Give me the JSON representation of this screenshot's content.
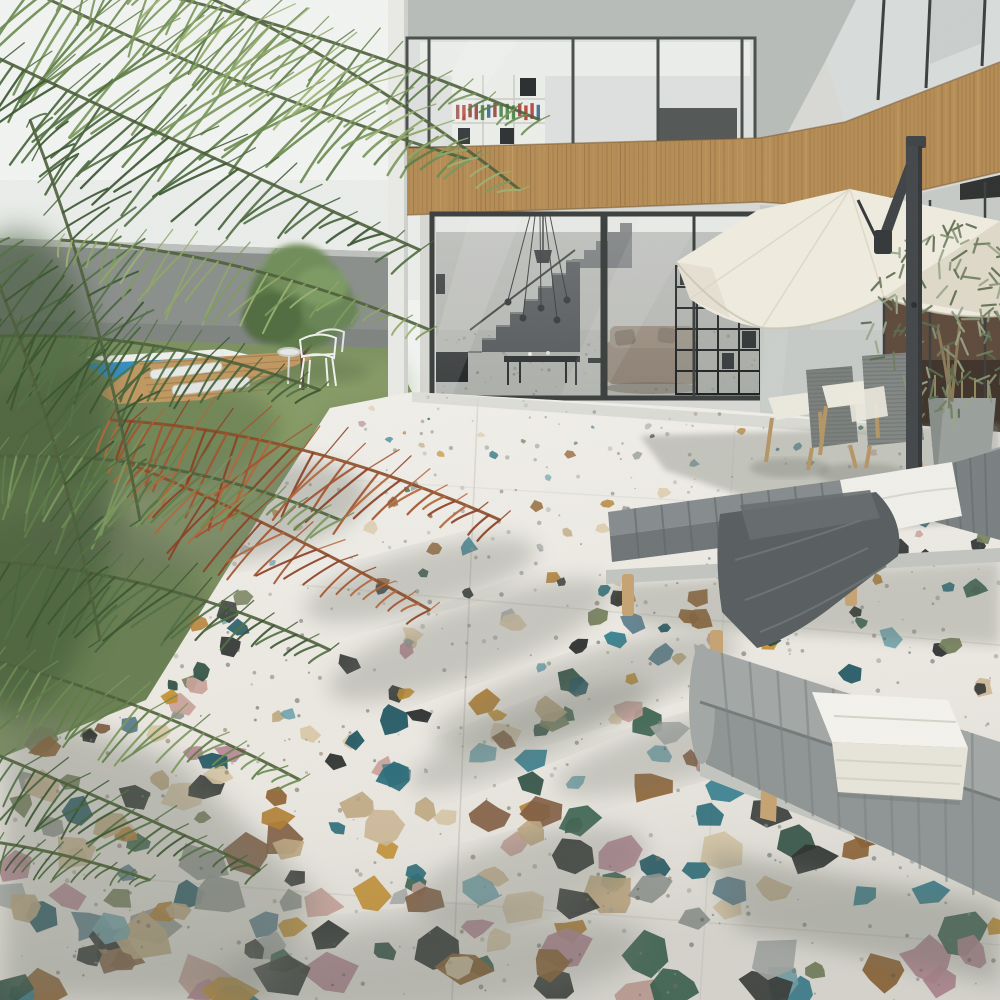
{
  "scene": {
    "title": "Outdoor patio of a modern villa with multicolor terrazzo floor, palm tree, pool, cantilever umbrella and sun loungers",
    "objects": {
      "palm_tree": "large palm with green and one dried orange frond, upper left",
      "boundary_wall": "grey garden wall",
      "lawn": "green grass lawn",
      "swimming_pool": "small blue pool with white coping and ladder",
      "pool_deck": "wooden deck with two white loungers",
      "garden_tree": "small leafy tree on lawn",
      "garden_chairs": "two white wire chairs with side table on grass",
      "villa": "two-storey villa, concrete, glass walls, wooden slat balustrade",
      "bookshelf_upstairs": "white bookshelf behind upper glass",
      "living_room": "sofa, coffee table, staircase, pendant lights, black grid shelf",
      "umbrella": "cream cantilever parasol with dark grey pole",
      "dining_chairs": "two grey rope chairs with wooden legs and white cushions",
      "olive_tree": "potted olive tree in grey planter",
      "sun_lounger_back": "grey channelled lounger with white pillow and dark grey blanket",
      "sun_lounger_front": "grey channelled lounger with white towel",
      "terrazzo_floor": "white terrazzo tiles with large multicolor chips and palm shadows"
    },
    "colors": {
      "sky": "#f2f4f2",
      "skyLow": "#e7eae7",
      "wall": "#8b8f8c",
      "wallDark": "#777b78",
      "grass": "#7c9060",
      "grassLight": "#93a76d",
      "water": "#3f9fd3",
      "waterDeep": "#2f86b5",
      "coping": "#eef0ec",
      "deck": "#c09760",
      "concrete": "#b8bcb8",
      "whiteWall": "#e9eae6",
      "glassUp": "#dde0de",
      "glassLow": "#c6cac7",
      "glassRight": "#d8dcda",
      "mullion": "#3b3f3d",
      "wood": "#b58c55",
      "woodDark": "#8a6438",
      "intWall": "#b4b6b2",
      "intFloor": "#adafab",
      "stair": "#54585a",
      "sofa": "#8d8174",
      "shelf": "#1d2020",
      "umbrella": "#efecdf",
      "umbrellaShade": "#d8d3c1",
      "pole": "#43474a",
      "rope": "#7b807d",
      "ropeLight": "#838885",
      "chairWood": "#b59565",
      "cushion": "#ebe9dd",
      "pot": "#9aa09c",
      "potShade": "#878d89",
      "oliveTrunk": "#8a7a58",
      "terrazzo": "#ebe8e1",
      "grout": "#c9c6be",
      "shadow": "#6f746b",
      "loungerTop": "#868c8e",
      "loungerFront": "#6f7577",
      "loungerBack": "#7a8082",
      "lounger2Top": "#a3a8a6",
      "lounger2Front": "#8f9594",
      "loungerWood": "#c5a372",
      "railGrey": "#c2c5bf",
      "pillow": "#f0efe9",
      "blanket": "#585e60",
      "blanketFold": "#6e7476",
      "towel": "#f3f2ec",
      "towelShade": "#e7e5da"
    },
    "palettes": {
      "chips": [
        "#cdb592",
        "#d8c6a4",
        "#bfa67e",
        "#c28c2c",
        "#b07a2a",
        "#8a5a28",
        "#1f6675",
        "#2a7a8c",
        "#174f5c",
        "#6fa3ad",
        "#202423",
        "#2b2f2c",
        "#24473a",
        "#2f5a46",
        "#6e7a52",
        "#b48391",
        "#c79f97",
        "#8e928e",
        "#a9adaa",
        "#54788a",
        "#7d5638"
      ],
      "specks": [
        "#6b6f6a",
        "#8a8d86",
        "#5b524a",
        "#7a6a55",
        "#4a4e4a",
        "#9a9d96"
      ],
      "palmDark": [
        "#3a5530",
        "#46633a",
        "#517044"
      ],
      "palmMid": [
        "#5d7c46",
        "#6b8a50",
        "#7a975c"
      ],
      "palmLight": [
        "#7f9a5d",
        "#8ea766",
        "#9bb273"
      ],
      "dried": [
        "#a1522c",
        "#8a3f22",
        "#b2653a"
      ],
      "olive": [
        "#6f7d5f",
        "#8a9579",
        "#5c6b4e",
        "#9aa68a"
      ],
      "books": [
        "#3c7a38",
        "#c2642d",
        "#ab3028",
        "#2e5f8a",
        "#8e3b33"
      ]
    }
  }
}
